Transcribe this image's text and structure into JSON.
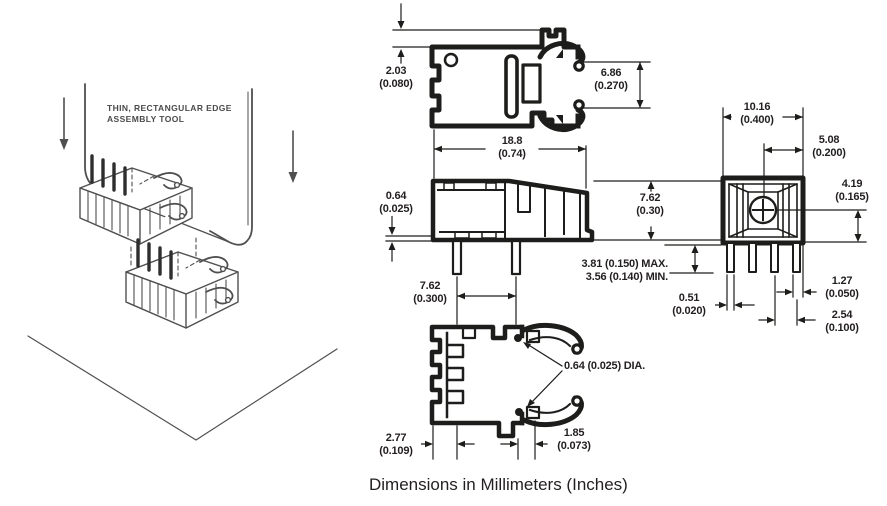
{
  "illustration": {
    "tool_label_line1": "THIN, RECTANGULAR EDGE",
    "tool_label_line2": "ASSEMBLY TOOL"
  },
  "caption": "Dimensions in Millimeters (Inches)",
  "dimensions": {
    "tab_height": {
      "mm": "2.03",
      "in": "(0.080)"
    },
    "jaw_opening": {
      "mm": "6.86",
      "in": "(0.270)"
    },
    "overall_length": {
      "mm": "18.8",
      "in": "(0.74)"
    },
    "standoff": {
      "mm": "0.64",
      "in": "(0.025)"
    },
    "body_height": {
      "mm": "7.62",
      "in": "(0.30)"
    },
    "pin_length": {
      "max": "3.81 (0.150) MAX.",
      "min": "3.56 (0.140) MIN."
    },
    "pin_spacing": {
      "mm": "7.62",
      "in": "(0.300)"
    },
    "wire_diameter": {
      "label": "0.64 (0.025) DIA."
    },
    "edge_offset": {
      "mm": "2.77",
      "in": "(0.109)"
    },
    "tab_width": {
      "mm": "1.85",
      "in": "(0.073)"
    },
    "body_width": {
      "mm": "10.16",
      "in": "(0.400)"
    },
    "center_offset": {
      "mm": "5.08",
      "in": "(0.200)"
    },
    "mount_height": {
      "mm": "4.19",
      "in": "(0.165)"
    },
    "pin_width": {
      "mm": "0.51",
      "in": "(0.020)"
    },
    "pin_edge_gap": {
      "mm": "1.27",
      "in": "(0.050)"
    },
    "pin_pitch": {
      "mm": "2.54",
      "in": "(0.100)"
    }
  }
}
